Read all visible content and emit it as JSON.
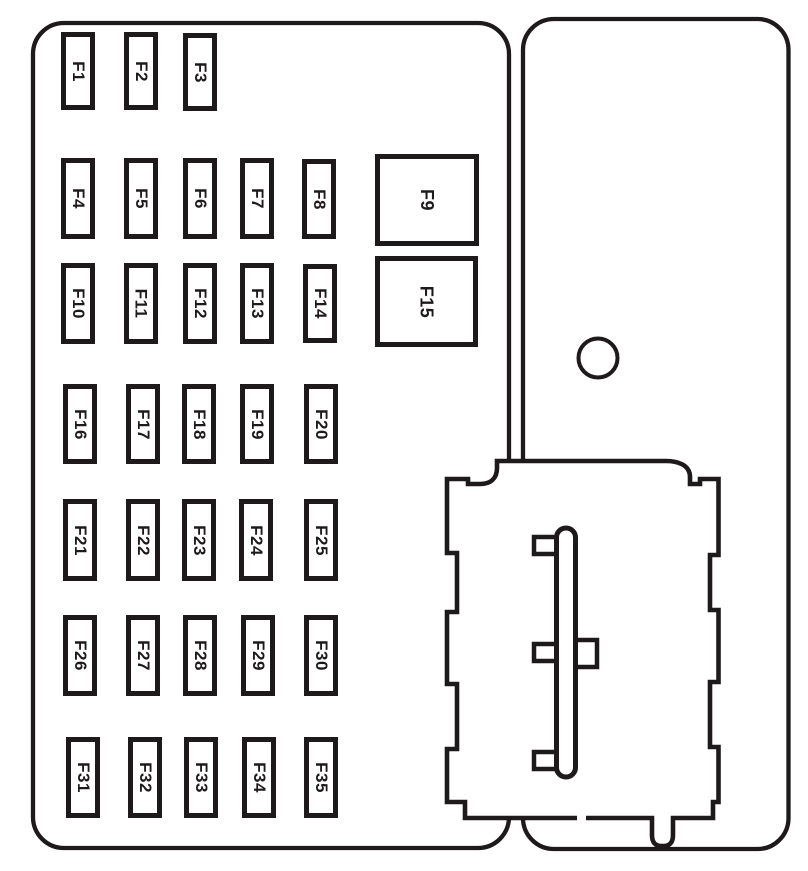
{
  "colors": {
    "line": "#1e1a1b",
    "background": "#ffffff"
  },
  "fuse_panel": {
    "fuses": [
      {
        "label": "F1",
        "x": 61,
        "y": 32,
        "w": 34,
        "h": 78,
        "size": "small"
      },
      {
        "label": "F2",
        "x": 124,
        "y": 32,
        "w": 34,
        "h": 78,
        "size": "small"
      },
      {
        "label": "F3",
        "x": 183,
        "y": 33,
        "w": 34,
        "h": 78,
        "size": "small"
      },
      {
        "label": "F4",
        "x": 61,
        "y": 158,
        "w": 34,
        "h": 81,
        "size": "small"
      },
      {
        "label": "F5",
        "x": 124,
        "y": 158,
        "w": 34,
        "h": 81,
        "size": "small"
      },
      {
        "label": "F6",
        "x": 183,
        "y": 158,
        "w": 34,
        "h": 81,
        "size": "small"
      },
      {
        "label": "F7",
        "x": 240,
        "y": 158,
        "w": 34,
        "h": 81,
        "size": "small"
      },
      {
        "label": "F8",
        "x": 302,
        "y": 159,
        "w": 34,
        "h": 80,
        "size": "small"
      },
      {
        "label": "F9",
        "x": 375,
        "y": 154,
        "w": 104,
        "h": 92,
        "size": "large"
      },
      {
        "label": "F10",
        "x": 61,
        "y": 263,
        "w": 34,
        "h": 81,
        "size": "small"
      },
      {
        "label": "F11",
        "x": 124,
        "y": 263,
        "w": 34,
        "h": 81,
        "size": "small"
      },
      {
        "label": "F12",
        "x": 183,
        "y": 263,
        "w": 34,
        "h": 81,
        "size": "small"
      },
      {
        "label": "F13",
        "x": 240,
        "y": 263,
        "w": 34,
        "h": 81,
        "size": "small"
      },
      {
        "label": "F14",
        "x": 303,
        "y": 264,
        "w": 34,
        "h": 79,
        "size": "small"
      },
      {
        "label": "F15",
        "x": 375,
        "y": 256,
        "w": 103,
        "h": 91,
        "size": "large"
      },
      {
        "label": "F16",
        "x": 63,
        "y": 384,
        "w": 34,
        "h": 80,
        "size": "small"
      },
      {
        "label": "F17",
        "x": 126,
        "y": 384,
        "w": 34,
        "h": 80,
        "size": "small"
      },
      {
        "label": "F18",
        "x": 182,
        "y": 384,
        "w": 34,
        "h": 80,
        "size": "small"
      },
      {
        "label": "F19",
        "x": 240,
        "y": 384,
        "w": 34,
        "h": 80,
        "size": "small"
      },
      {
        "label": "F20",
        "x": 304,
        "y": 384,
        "w": 34,
        "h": 80,
        "size": "small"
      },
      {
        "label": "F21",
        "x": 63,
        "y": 499,
        "w": 34,
        "h": 82,
        "size": "small"
      },
      {
        "label": "F22",
        "x": 126,
        "y": 499,
        "w": 34,
        "h": 82,
        "size": "small"
      },
      {
        "label": "F23",
        "x": 182,
        "y": 499,
        "w": 34,
        "h": 82,
        "size": "small"
      },
      {
        "label": "F24",
        "x": 239,
        "y": 499,
        "w": 34,
        "h": 82,
        "size": "small"
      },
      {
        "label": "F25",
        "x": 304,
        "y": 499,
        "w": 34,
        "h": 82,
        "size": "small"
      },
      {
        "label": "F26",
        "x": 63,
        "y": 615,
        "w": 34,
        "h": 81,
        "size": "small"
      },
      {
        "label": "F27",
        "x": 126,
        "y": 615,
        "w": 34,
        "h": 81,
        "size": "small"
      },
      {
        "label": "F28",
        "x": 183,
        "y": 615,
        "w": 34,
        "h": 81,
        "size": "small"
      },
      {
        "label": "F29",
        "x": 241,
        "y": 615,
        "w": 34,
        "h": 81,
        "size": "small"
      },
      {
        "label": "F30",
        "x": 304,
        "y": 615,
        "w": 34,
        "h": 81,
        "size": "small"
      },
      {
        "label": "F31",
        "x": 66,
        "y": 737,
        "w": 34,
        "h": 81,
        "size": "small"
      },
      {
        "label": "F32",
        "x": 128,
        "y": 737,
        "w": 34,
        "h": 81,
        "size": "small"
      },
      {
        "label": "F33",
        "x": 184,
        "y": 737,
        "w": 34,
        "h": 81,
        "size": "small"
      },
      {
        "label": "F34",
        "x": 242,
        "y": 737,
        "w": 34,
        "h": 81,
        "size": "small"
      },
      {
        "label": "F35",
        "x": 304,
        "y": 737,
        "w": 34,
        "h": 81,
        "size": "small"
      }
    ]
  }
}
